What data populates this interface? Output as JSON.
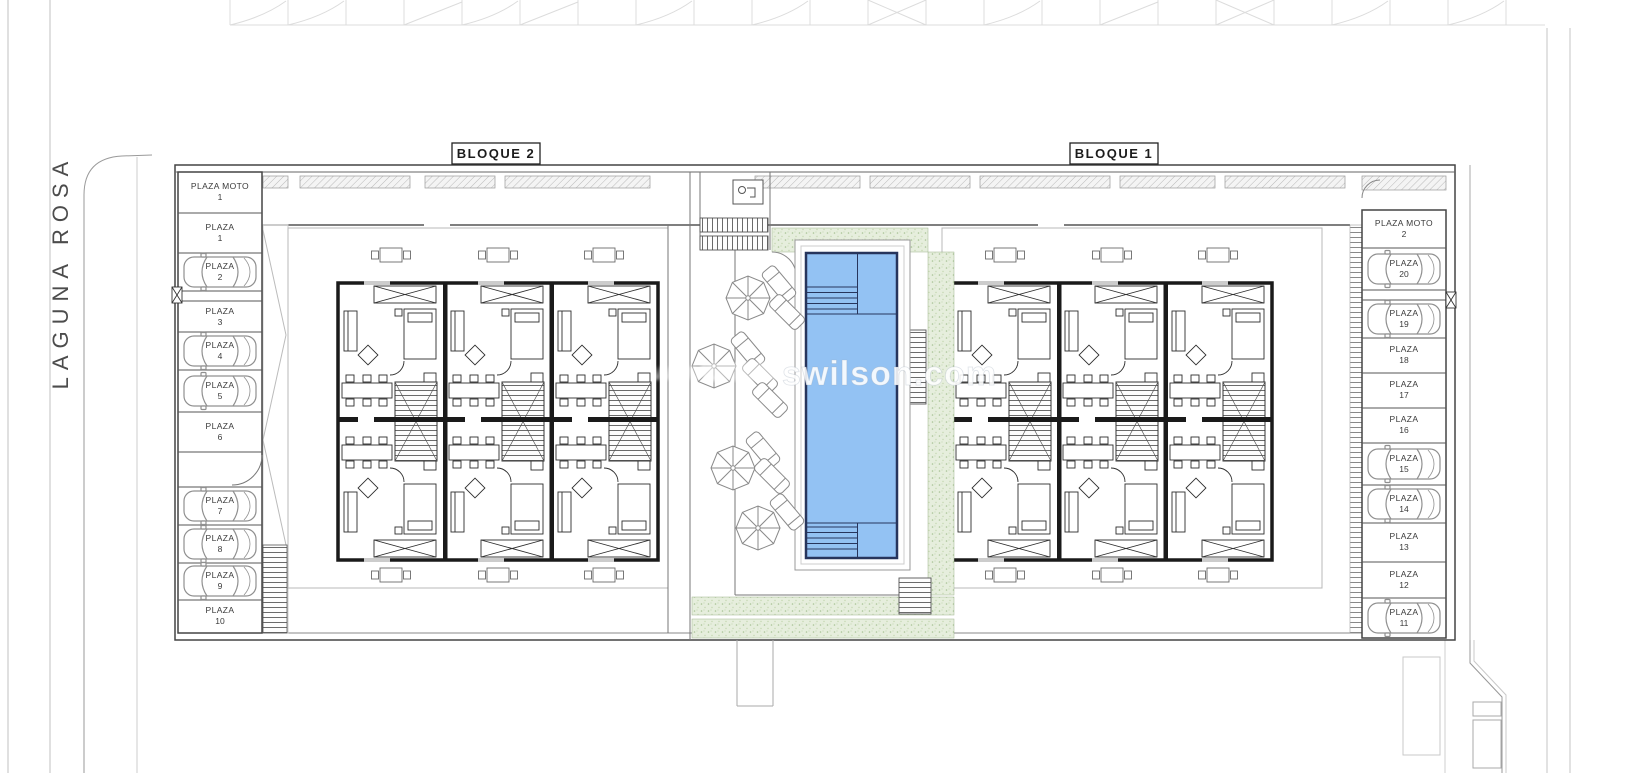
{
  "street": {
    "name": "LAGUNA ROSA"
  },
  "blocks": [
    {
      "label": "BLOQUE 2"
    },
    {
      "label": "BLOQUE 1"
    }
  ],
  "watermark": {
    "prefix": "www.",
    "domain": "swilson.com"
  },
  "parking_left": {
    "stalls": [
      {
        "label": "PLAZA MOTO",
        "number": "1",
        "car": false
      },
      {
        "label": "PLAZA",
        "number": "1",
        "car": false
      },
      {
        "label": "PLAZA",
        "number": "2",
        "car": true
      },
      {
        "label": "PLAZA",
        "number": "3",
        "car": false
      },
      {
        "label": "PLAZA",
        "number": "4",
        "car": true
      },
      {
        "label": "PLAZA",
        "number": "5",
        "car": true
      },
      {
        "label": "PLAZA",
        "number": "6",
        "car": false
      },
      {
        "label": "PLAZA",
        "number": "7",
        "car": true
      },
      {
        "label": "PLAZA",
        "number": "8",
        "car": true
      },
      {
        "label": "PLAZA",
        "number": "9",
        "car": true
      },
      {
        "label": "PLAZA",
        "number": "10",
        "car": false
      }
    ]
  },
  "parking_right": {
    "stalls": [
      {
        "label": "PLAZA MOTO",
        "number": "2",
        "car": false
      },
      {
        "label": "PLAZA",
        "number": "20",
        "car": true
      },
      {
        "label": "PLAZA",
        "number": "19",
        "car": true
      },
      {
        "label": "PLAZA",
        "number": "18",
        "car": false
      },
      {
        "label": "PLAZA",
        "number": "17",
        "car": false
      },
      {
        "label": "PLAZA",
        "number": "16",
        "car": false
      },
      {
        "label": "PLAZA",
        "number": "15",
        "car": true
      },
      {
        "label": "PLAZA",
        "number": "14",
        "car": true
      },
      {
        "label": "PLAZA",
        "number": "13",
        "car": false
      },
      {
        "label": "PLAZA",
        "number": "12",
        "car": false
      },
      {
        "label": "PLAZA",
        "number": "11",
        "car": true
      }
    ]
  },
  "colors": {
    "pool_fill": "#93c2f3",
    "pool_outline": "#27355c",
    "green_fill": "#e6eedd",
    "wall": "#1a1a1a",
    "drawing_gray": "#8a8a8a",
    "faint_gray": "#dcdcdc"
  }
}
